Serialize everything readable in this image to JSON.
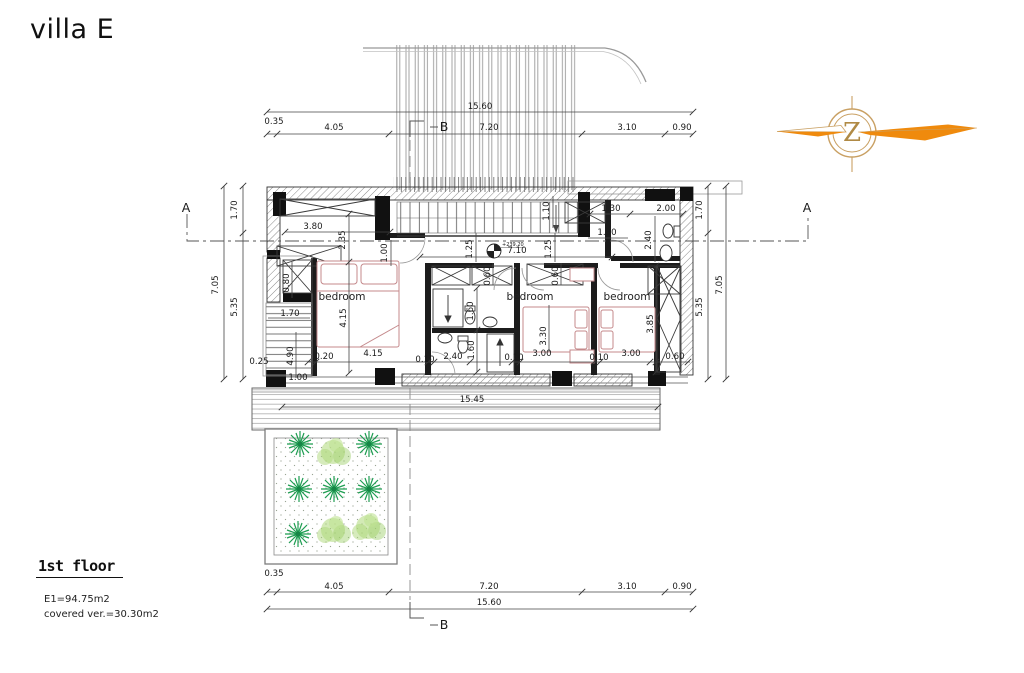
{
  "page": {
    "title": "villa E",
    "background": "#ffffff"
  },
  "footer": {
    "floor_label": "1st floor",
    "area_line1": "E1=94.75m2",
    "area_line2": "covered ver.=30.30m2"
  },
  "logo": {
    "letter": "Z",
    "orange": "#EF8A0D",
    "gold": "#C9A063"
  },
  "colors": {
    "wall": "#111111",
    "line": "#444444",
    "furniture_red": "#c4898b",
    "plant_dark": "#1f9e52",
    "plant_light": "#aed87a"
  },
  "plan": {
    "level_marker": {
      "t": "+239.20",
      "x": 502,
      "y": 246
    },
    "room_labels": [
      {
        "t": "bedroom",
        "x": 342,
        "y": 300
      },
      {
        "t": "bedroom",
        "x": 530,
        "y": 300
      },
      {
        "t": "bedroom",
        "x": 627,
        "y": 300
      }
    ],
    "section_markers": [
      {
        "t": "A",
        "x": 186,
        "y": 212
      },
      {
        "t": "A",
        "x": 807,
        "y": 212
      },
      {
        "t": "B",
        "x": 444,
        "y": 131
      },
      {
        "t": "B",
        "x": 444,
        "y": 629
      }
    ],
    "dimensions": [
      {
        "t": "15.60",
        "x": 480,
        "y": 109
      },
      {
        "t": "0.35",
        "x": 274,
        "y": 124
      },
      {
        "t": "4.05",
        "x": 334,
        "y": 130
      },
      {
        "t": "7.20",
        "x": 489,
        "y": 130
      },
      {
        "t": "3.10",
        "x": 627,
        "y": 130
      },
      {
        "t": "0.90",
        "x": 682,
        "y": 130
      },
      {
        "t": "7.05",
        "x": 218,
        "y": 285,
        "r": -90
      },
      {
        "t": "1.70",
        "x": 237,
        "y": 210,
        "r": -90
      },
      {
        "t": "5.35",
        "x": 237,
        "y": 307,
        "r": -90
      },
      {
        "t": "0.25",
        "x": 259,
        "y": 364
      },
      {
        "t": "1.70",
        "x": 702,
        "y": 210,
        "r": -90
      },
      {
        "t": "5.35",
        "x": 702,
        "y": 307,
        "r": -90
      },
      {
        "t": "7.05",
        "x": 722,
        "y": 285,
        "r": -90
      },
      {
        "t": "3.80",
        "x": 313,
        "y": 229
      },
      {
        "t": "2.35",
        "x": 345,
        "y": 240,
        "r": -90
      },
      {
        "t": "1.00",
        "x": 387,
        "y": 253,
        "r": -90
      },
      {
        "t": "1.10",
        "x": 549,
        "y": 211,
        "r": -90
      },
      {
        "t": "1.25",
        "x": 472,
        "y": 249,
        "r": -90
      },
      {
        "t": "1.25",
        "x": 551,
        "y": 249,
        "r": -90
      },
      {
        "t": "7.10",
        "x": 517,
        "y": 253
      },
      {
        "t": "1.30",
        "x": 611,
        "y": 211
      },
      {
        "t": "2.00",
        "x": 666,
        "y": 211
      },
      {
        "t": "1.30",
        "x": 607,
        "y": 235
      },
      {
        "t": "2.40",
        "x": 651,
        "y": 240,
        "r": -90
      },
      {
        "t": "0.80",
        "x": 289,
        "y": 283,
        "r": -90
      },
      {
        "t": "1.70",
        "x": 290,
        "y": 316
      },
      {
        "t": "4.90",
        "x": 293,
        "y": 356,
        "r": -90
      },
      {
        "t": "1.00",
        "x": 298,
        "y": 380
      },
      {
        "t": "4.15",
        "x": 346,
        "y": 318,
        "r": -90
      },
      {
        "t": "0.60",
        "x": 490,
        "y": 276,
        "r": -90
      },
      {
        "t": "0.60",
        "x": 558,
        "y": 276,
        "r": -90
      },
      {
        "t": "1.60",
        "x": 473,
        "y": 311,
        "r": -90
      },
      {
        "t": "1.60",
        "x": 474,
        "y": 350,
        "r": -90
      },
      {
        "t": "3.30",
        "x": 546,
        "y": 336,
        "r": -90
      },
      {
        "t": "3.85",
        "x": 653,
        "y": 324,
        "r": -90
      },
      {
        "t": "0.20",
        "x": 324,
        "y": 359
      },
      {
        "t": "4.15",
        "x": 373,
        "y": 356
      },
      {
        "t": "0.10",
        "x": 425,
        "y": 362
      },
      {
        "t": "2.40",
        "x": 453,
        "y": 359
      },
      {
        "t": "0.10",
        "x": 514,
        "y": 360
      },
      {
        "t": "3.00",
        "x": 542,
        "y": 356
      },
      {
        "t": "0.10",
        "x": 599,
        "y": 360
      },
      {
        "t": "3.00",
        "x": 631,
        "y": 356
      },
      {
        "t": "0.60",
        "x": 675,
        "y": 359
      },
      {
        "t": "15.45",
        "x": 472,
        "y": 402
      },
      {
        "t": "0.35",
        "x": 274,
        "y": 576
      },
      {
        "t": "4.05",
        "x": 334,
        "y": 589
      },
      {
        "t": "7.20",
        "x": 489,
        "y": 589
      },
      {
        "t": "3.10",
        "x": 627,
        "y": 589
      },
      {
        "t": "0.90",
        "x": 682,
        "y": 589
      },
      {
        "t": "15.60",
        "x": 489,
        "y": 605
      }
    ]
  }
}
